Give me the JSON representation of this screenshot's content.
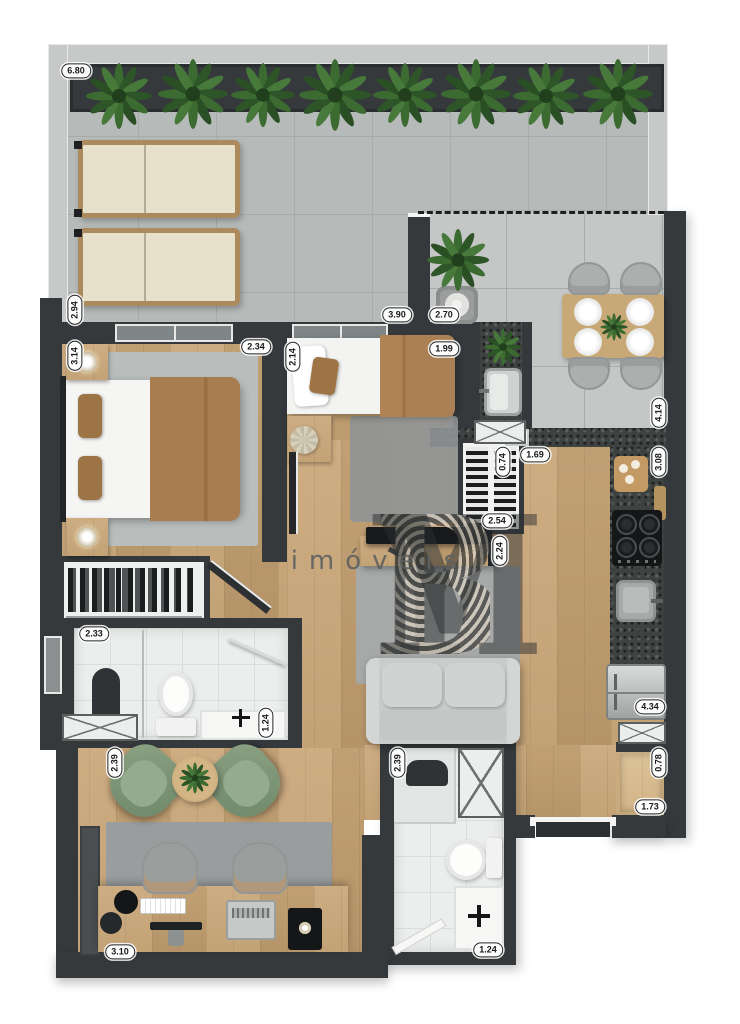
{
  "watermark": {
    "brand_y": "Y",
    "brand_b": "B",
    "brand_m": "M",
    "tagline": "imóveis"
  },
  "theme": {
    "wall": "#35393b",
    "wallLight": "#45494b",
    "terrace": "#b6bab9",
    "dining": "#c4c7c6",
    "grid": "#a7abaa",
    "wood": "#cba87a",
    "woodDark": "#bf9c6e",
    "woodLight": "#dcc298",
    "granite": "#3e4341",
    "tile": "#eceeed",
    "rug": "#a6a9a7",
    "rugDark": "#8f9496",
    "rugBed": "#b9bdbc",
    "sofa": "#c9ccca",
    "sage": "#7e9478",
    "cushion": "#e7e1cc",
    "frameWood": "#ab8b5d",
    "blanket": "#a87e51",
    "steel": "#c3c6c5",
    "badgeBg": "#fdfdfc",
    "badgeInk": "#17191a",
    "plantGreen": "#3c6b32",
    "plantDark": "#2e5527"
  },
  "dimensions": [
    {
      "value": "6.80",
      "cx": 76,
      "cy": 71,
      "o": "h"
    },
    {
      "value": "2.94",
      "cx": 75,
      "cy": 310,
      "o": "v"
    },
    {
      "value": "3.14",
      "cx": 75,
      "cy": 356,
      "o": "v"
    },
    {
      "value": "2.34",
      "cx": 256,
      "cy": 347,
      "o": "h"
    },
    {
      "value": "2.14",
      "cx": 293,
      "cy": 357,
      "o": "v"
    },
    {
      "value": "1.99",
      "cx": 444,
      "cy": 349,
      "o": "h"
    },
    {
      "value": "3.90",
      "cx": 397,
      "cy": 315,
      "o": "h"
    },
    {
      "value": "2.70",
      "cx": 444,
      "cy": 315,
      "o": "h"
    },
    {
      "value": "4.14",
      "cx": 659,
      "cy": 413,
      "o": "v"
    },
    {
      "value": "3.08",
      "cx": 659,
      "cy": 462,
      "o": "v"
    },
    {
      "value": "1.69",
      "cx": 535,
      "cy": 455,
      "o": "h"
    },
    {
      "value": "0.74",
      "cx": 503,
      "cy": 462,
      "o": "v"
    },
    {
      "value": "2.54",
      "cx": 497,
      "cy": 521,
      "o": "h"
    },
    {
      "value": "2.24",
      "cx": 500,
      "cy": 551,
      "o": "v"
    },
    {
      "value": "4.34",
      "cx": 650,
      "cy": 707,
      "o": "h"
    },
    {
      "value": "0.78",
      "cx": 659,
      "cy": 763,
      "o": "v"
    },
    {
      "value": "1.73",
      "cx": 650,
      "cy": 807,
      "o": "h"
    },
    {
      "value": "2.33",
      "cx": 94,
      "cy": 634,
      "o": "h"
    },
    {
      "value": "1.24",
      "cx": 266,
      "cy": 723,
      "o": "v"
    },
    {
      "value": "2.39",
      "cx": 115,
      "cy": 763,
      "o": "v"
    },
    {
      "value": "2.39",
      "cx": 398,
      "cy": 763,
      "o": "v"
    },
    {
      "value": "1.24",
      "cx": 488,
      "cy": 950,
      "o": "h"
    },
    {
      "value": "3.10",
      "cx": 120,
      "cy": 952,
      "o": "h"
    }
  ]
}
